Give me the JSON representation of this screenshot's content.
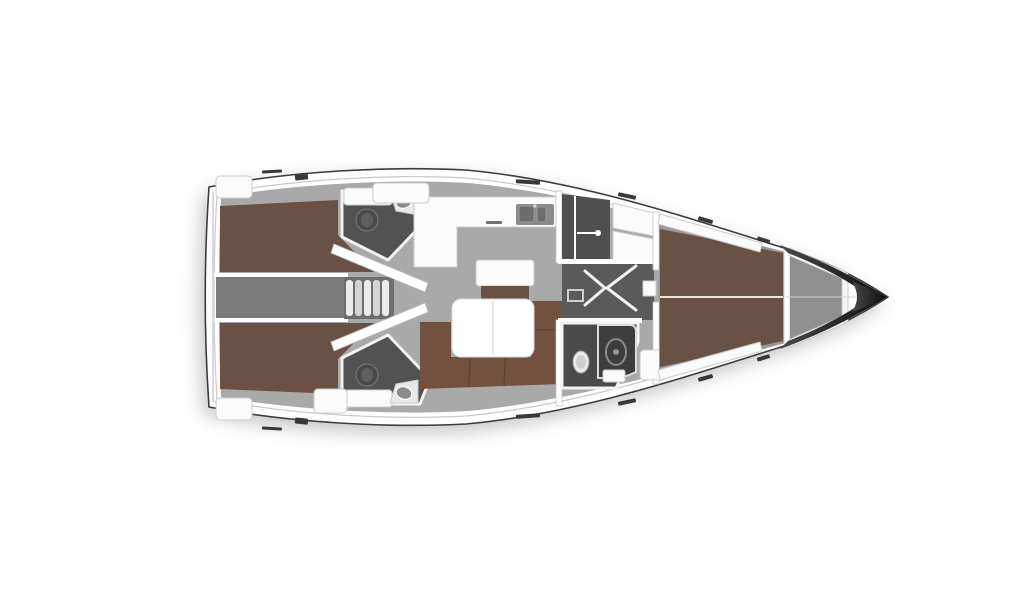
{
  "figure": {
    "type": "diagram",
    "subject": "sailing-yacht-interior-floor-plan",
    "orientation": "bow-right",
    "background": "#ffffff"
  },
  "colors": {
    "hull_fill": "#ffffff",
    "hull_line": "#3c3c3c",
    "floor": "#a9a9a9",
    "floor_forward": "#989898",
    "corridor": "#7c7c7c",
    "hallway": "#5a5a5a",
    "head_floor": "#525252",
    "locker_dark": "#4f4f4f",
    "shower_dark": "#3d3d3d",
    "berth_brown": "#6a5146",
    "sofa_brown": "#72513e",
    "furniture_white": "#fbfbfb",
    "wall_white": "#ffffff",
    "sink_grey": "#8a8a8a",
    "basin_grey": "#6d6d6d",
    "toilet_dark": "#4a4a4a",
    "toilet_inner": "#5f5f5f",
    "fixture_white": "#e9e9e9",
    "fixture_inner": "#cfcfcf",
    "step_light": "#ececec",
    "step_mid": "#d4d4d4",
    "steps_well": "#6e6e6e",
    "anchor_locker": "#8f8f8f",
    "bow_dark_start": "#4a4a4a",
    "bow_dark_end": "#0c0c0c",
    "hatch_dark": "#383838",
    "counter_item_dark": "#707070",
    "berth_seam": "#e8e4e0",
    "centerline_grey": "#d5d5d5"
  },
  "parts": [
    "hull",
    "deck-band",
    "interior-floor",
    "aft-cabin-port-berth",
    "aft-cabin-starboard-berth",
    "engine-corridor",
    "companionway-steps",
    "aft-head-port",
    "aft-head-starboard",
    "toilet",
    "washbasin",
    "vanity-counter",
    "galley-counter",
    "galley-sink",
    "chart-sideboard",
    "saloon-table",
    "saloon-sofa",
    "wet-locker",
    "locker-door-handle",
    "wardrobe-lockers",
    "hallway",
    "door-swing",
    "forward-head",
    "shower-cabin",
    "forward-cabin-berth",
    "side-shelf",
    "bedside-unit",
    "anchor-locker",
    "bow-tip",
    "deck-hatch"
  ]
}
